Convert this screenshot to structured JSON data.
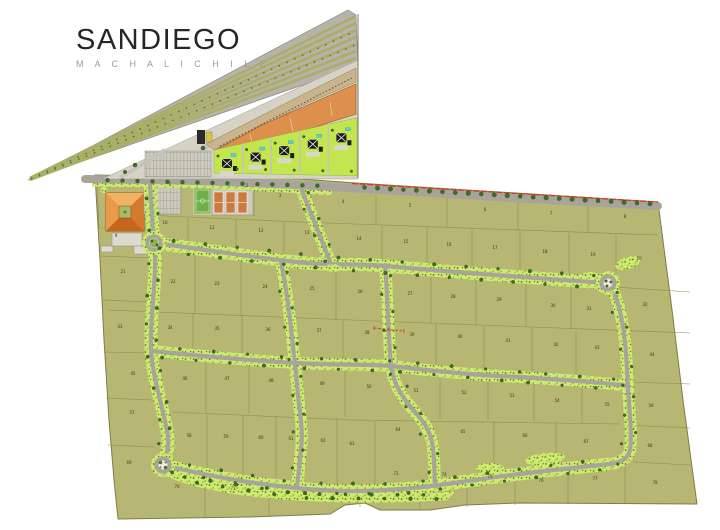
{
  "title": {
    "name": "SANDIEGO",
    "location": "M A C H A L I  C H I L E"
  },
  "map": {
    "features": [
      "highway-corridor",
      "commercial-strip",
      "housing-clusters",
      "wedge-parking-lot",
      "parking-lot",
      "hacienda-building",
      "soccer-field",
      "tennis-courts",
      "roundabout-northwest",
      "roundabout-east",
      "roundabout-southwest",
      "boundary-red-line",
      "red-dashed-annotation",
      "tree-lined-roads",
      "numbered-lots"
    ],
    "colors": {
      "land": "#b7b673",
      "lot_line": "#8d8c54",
      "road": "#a8a49c",
      "verge": "#cfe96e",
      "verge_dot": "#4e7c2a",
      "tree": "#3e6e28",
      "band_gray": "#b7b3ab",
      "band_green": "#a9af69",
      "building_orange": "#e08838",
      "commercial_orange": "#dd8f4d",
      "commercial_tan": "#c9b48e",
      "housing_green": "#c3e64f",
      "house_black": "#1c1c1c",
      "pool_cyan": "#62ccd8",
      "court_orange": "#cc7a3d",
      "field_green": "#6fae49",
      "paving": "#cdcabf",
      "red": "#d13a28",
      "white": "#ffffff"
    },
    "lot_numbers": [
      {
        "n": "1",
        "x": 170,
        "y": 186
      },
      {
        "n": "2",
        "x": 247,
        "y": 187
      },
      {
        "n": "3",
        "x": 280,
        "y": 197
      },
      {
        "n": "4",
        "x": 343,
        "y": 203
      },
      {
        "n": "5",
        "x": 410,
        "y": 207
      },
      {
        "n": "6",
        "x": 485,
        "y": 211
      },
      {
        "n": "7",
        "x": 551,
        "y": 215
      },
      {
        "n": "8",
        "x": 625,
        "y": 218
      },
      {
        "n": "9",
        "x": 116,
        "y": 237
      },
      {
        "n": "10",
        "x": 165,
        "y": 224
      },
      {
        "n": "11",
        "x": 212,
        "y": 229
      },
      {
        "n": "12",
        "x": 261,
        "y": 232
      },
      {
        "n": "13",
        "x": 307,
        "y": 234
      },
      {
        "n": "14",
        "x": 359,
        "y": 240
      },
      {
        "n": "15",
        "x": 406,
        "y": 243
      },
      {
        "n": "16",
        "x": 449,
        "y": 246
      },
      {
        "n": "17",
        "x": 495,
        "y": 249
      },
      {
        "n": "18",
        "x": 545,
        "y": 253
      },
      {
        "n": "19",
        "x": 593,
        "y": 256
      },
      {
        "n": "20",
        "x": 639,
        "y": 260
      },
      {
        "n": "21",
        "x": 123,
        "y": 273
      },
      {
        "n": "22",
        "x": 173,
        "y": 283
      },
      {
        "n": "23",
        "x": 217,
        "y": 285
      },
      {
        "n": "24",
        "x": 265,
        "y": 288
      },
      {
        "n": "25",
        "x": 312,
        "y": 290
      },
      {
        "n": "26",
        "x": 360,
        "y": 293
      },
      {
        "n": "27",
        "x": 410,
        "y": 295
      },
      {
        "n": "28",
        "x": 453,
        "y": 298
      },
      {
        "n": "29",
        "x": 499,
        "y": 301
      },
      {
        "n": "30",
        "x": 553,
        "y": 307
      },
      {
        "n": "31",
        "x": 589,
        "y": 310
      },
      {
        "n": "32",
        "x": 645,
        "y": 306
      },
      {
        "n": "33",
        "x": 120,
        "y": 328
      },
      {
        "n": "34",
        "x": 170,
        "y": 329
      },
      {
        "n": "35",
        "x": 217,
        "y": 330
      },
      {
        "n": "36",
        "x": 268,
        "y": 331
      },
      {
        "n": "37",
        "x": 319,
        "y": 332
      },
      {
        "n": "38",
        "x": 367,
        "y": 334
      },
      {
        "n": "39",
        "x": 412,
        "y": 336
      },
      {
        "n": "40",
        "x": 460,
        "y": 338
      },
      {
        "n": "41",
        "x": 508,
        "y": 342
      },
      {
        "n": "42",
        "x": 556,
        "y": 346
      },
      {
        "n": "43",
        "x": 597,
        "y": 349
      },
      {
        "n": "44",
        "x": 652,
        "y": 356
      },
      {
        "n": "45",
        "x": 133,
        "y": 375
      },
      {
        "n": "46",
        "x": 185,
        "y": 380
      },
      {
        "n": "47",
        "x": 227,
        "y": 380
      },
      {
        "n": "48",
        "x": 271,
        "y": 382
      },
      {
        "n": "49",
        "x": 322,
        "y": 385
      },
      {
        "n": "50",
        "x": 369,
        "y": 388
      },
      {
        "n": "51",
        "x": 416,
        "y": 392
      },
      {
        "n": "52",
        "x": 464,
        "y": 394
      },
      {
        "n": "53",
        "x": 512,
        "y": 397
      },
      {
        "n": "54",
        "x": 557,
        "y": 402
      },
      {
        "n": "55",
        "x": 607,
        "y": 406
      },
      {
        "n": "56",
        "x": 651,
        "y": 407
      },
      {
        "n": "57",
        "x": 132,
        "y": 414
      },
      {
        "n": "58",
        "x": 189,
        "y": 437
      },
      {
        "n": "59",
        "x": 226,
        "y": 438
      },
      {
        "n": "60",
        "x": 261,
        "y": 439
      },
      {
        "n": "61",
        "x": 291,
        "y": 440
      },
      {
        "n": "62",
        "x": 323,
        "y": 442
      },
      {
        "n": "63",
        "x": 352,
        "y": 445
      },
      {
        "n": "64",
        "x": 398,
        "y": 431
      },
      {
        "n": "65",
        "x": 463,
        "y": 433
      },
      {
        "n": "66",
        "x": 525,
        "y": 437
      },
      {
        "n": "67",
        "x": 586,
        "y": 443
      },
      {
        "n": "68",
        "x": 650,
        "y": 447
      },
      {
        "n": "69",
        "x": 129,
        "y": 464
      },
      {
        "n": "70",
        "x": 177,
        "y": 488
      },
      {
        "n": "71",
        "x": 233,
        "y": 490
      },
      {
        "n": "72",
        "x": 305,
        "y": 495
      },
      {
        "n": "73",
        "x": 396,
        "y": 475
      },
      {
        "n": "74",
        "x": 444,
        "y": 476
      },
      {
        "n": "75",
        "x": 490,
        "y": 478
      },
      {
        "n": "76",
        "x": 541,
        "y": 482
      },
      {
        "n": "77",
        "x": 595,
        "y": 480
      },
      {
        "n": "78",
        "x": 655,
        "y": 484
      }
    ]
  }
}
